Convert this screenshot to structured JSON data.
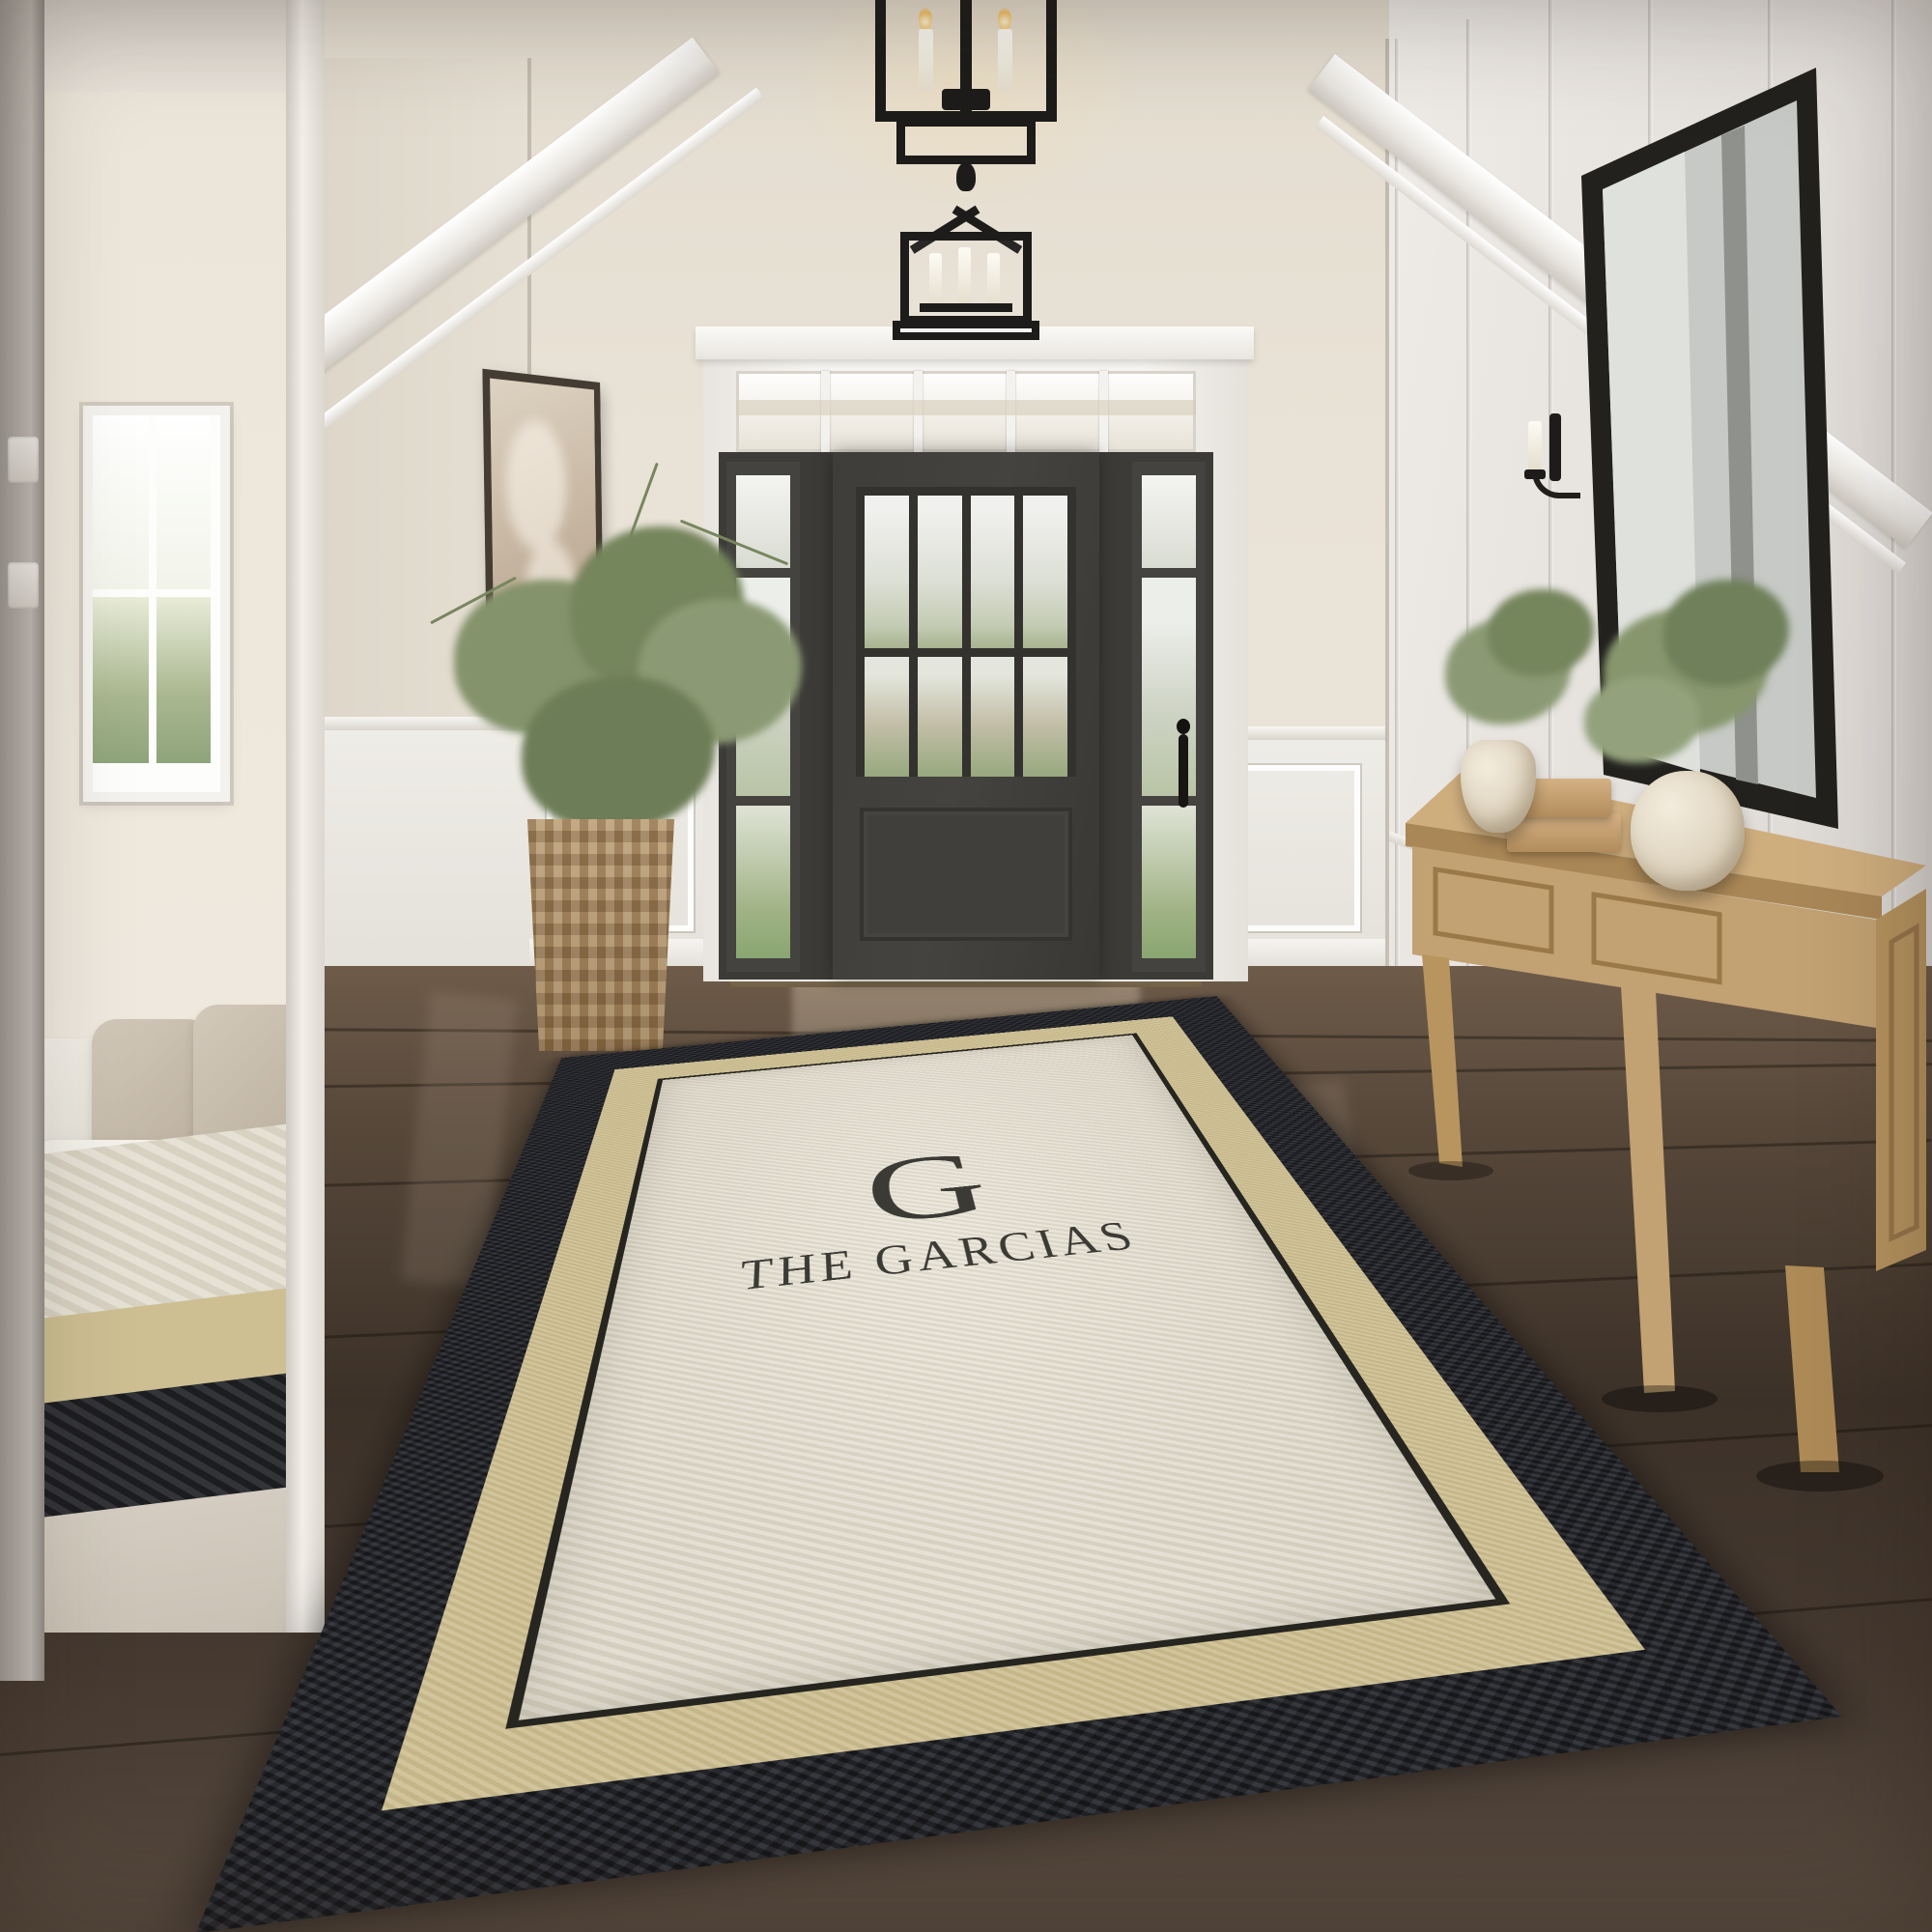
{
  "scene": {
    "setting": "entryway-photo",
    "rug": {
      "monogram_letter": "G",
      "family_name": "THE GARCIAS",
      "border_color": "#24252a",
      "band_color": "#cdbf92",
      "field_color": "#e3ded1",
      "text_color": "#3b3a35"
    },
    "palette": {
      "wall_cream": "#e7e0d4",
      "trim_white": "#f2efe9",
      "door_charcoal": "#3e3d3a",
      "floor_dark_wood": "#46372c",
      "oak_wood": "#c2a172",
      "foliage_green": "#7f8d68",
      "iron_black": "#1d1c1a"
    }
  }
}
